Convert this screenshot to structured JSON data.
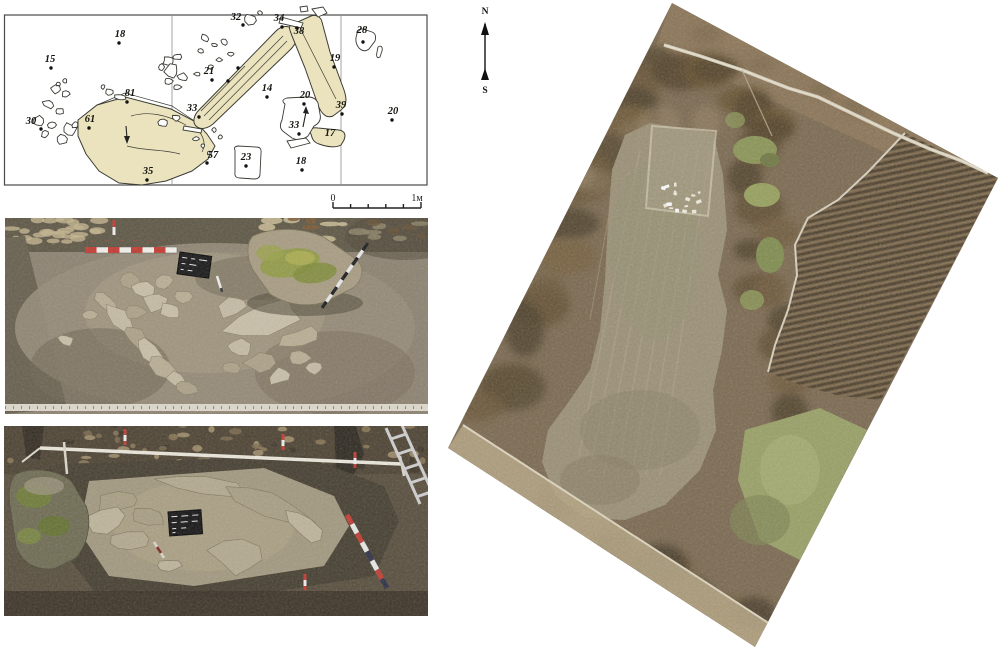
{
  "compass": {
    "north": "N",
    "south": "S"
  },
  "plan": {
    "scale_bar": {
      "start": "0",
      "end": "1м",
      "intervals": 5
    },
    "colors": {
      "stone_fill": "#eae3bd",
      "outline": "#3c3c35",
      "grid": "#8f8f8f",
      "background": "#ffffff"
    },
    "points": [
      {
        "n": "15",
        "lx": 50,
        "ly": 62,
        "dx": 51,
        "dy": 68
      },
      {
        "n": "18",
        "lx": 120,
        "ly": 37,
        "dx": 119,
        "dy": 43
      },
      {
        "n": "30",
        "lx": 31,
        "ly": 124,
        "dx": 41,
        "dy": 129
      },
      {
        "n": "61",
        "lx": 90,
        "ly": 122,
        "dx": 89,
        "dy": 128
      },
      {
        "n": "81",
        "lx": 130,
        "ly": 96,
        "dx": 127,
        "dy": 102
      },
      {
        "n": "35",
        "lx": 148,
        "ly": 174,
        "dx": 147,
        "dy": 180
      },
      {
        "n": "57",
        "lx": 213,
        "ly": 158,
        "dx": 207,
        "dy": 163
      },
      {
        "n": "33",
        "lx": 192,
        "ly": 111,
        "dx": 199,
        "dy": 117
      },
      {
        "n": "21",
        "lx": 209,
        "ly": 74,
        "dx": 212,
        "dy": 80
      },
      {
        "n": "32",
        "lx": 236,
        "ly": 20,
        "dx": 243,
        "dy": 25
      },
      {
        "n": "34",
        "lx": 279,
        "ly": 21,
        "dx": 282,
        "dy": 27
      },
      {
        "n": "38",
        "lx": 299,
        "ly": 34,
        "dx": 297,
        "dy": 28
      },
      {
        "n": "19",
        "lx": 335,
        "ly": 61,
        "dx": 334,
        "dy": 67
      },
      {
        "n": "28",
        "lx": 362,
        "ly": 33,
        "dx": 363,
        "dy": 42
      },
      {
        "n": "14",
        "lx": 267,
        "ly": 91,
        "dx": 267,
        "dy": 97
      },
      {
        "n": "20",
        "lx": 305,
        "ly": 98,
        "dx": 304,
        "dy": 104
      },
      {
        "n": "33",
        "lx": 294,
        "ly": 128,
        "dx": 299,
        "dy": 134
      },
      {
        "n": "17",
        "lx": 330,
        "ly": 136,
        "dx": null,
        "dy": null
      },
      {
        "n": "39",
        "lx": 341,
        "ly": 108,
        "dx": 342,
        "dy": 114
      },
      {
        "n": "20",
        "lx": 393,
        "ly": 114,
        "dx": 392,
        "dy": 120
      },
      {
        "n": "23",
        "lx": 246,
        "ly": 160,
        "dx": 246,
        "dy": 166
      },
      {
        "n": "18",
        "lx": 301,
        "ly": 164,
        "dx": 302,
        "dy": 170
      }
    ],
    "extra_dots": [
      {
        "x": 238,
        "y": 68
      },
      {
        "x": 228,
        "y": 81
      }
    ]
  },
  "aerial": {
    "colors": {
      "terrain": "#7b6950",
      "dark_trees": "#55462f",
      "central_field": "#9b9076",
      "plowed_field": "#6e5b42",
      "plowed_stripe": "#4c3e2b",
      "green_field": "#98a065",
      "road": "#d8d0ba"
    }
  },
  "photos": {
    "colors": {
      "soil_light": "#8d8271",
      "soil_dark": "#574d3c",
      "stone_gray": "#b9ae95",
      "moss_green": "#8f9b40",
      "survey_red": "#c23b31",
      "tape_white": "#ded9cc"
    }
  }
}
